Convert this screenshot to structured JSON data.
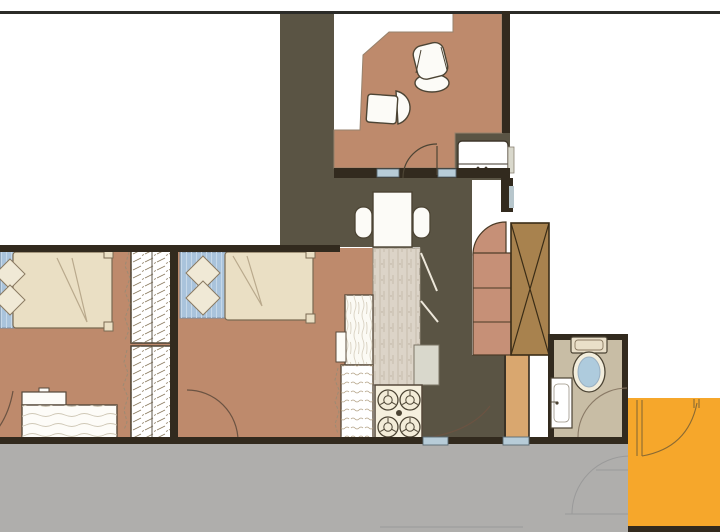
{
  "scene": {
    "type": "floor-plan"
  },
  "colors": {
    "floor_tan": "#BE8A6C",
    "hall_olive": "#5A5444",
    "corridor_gray": "#AFAEAC",
    "orange_room": "#F6A72B",
    "wall_dark": "#322A1E",
    "top_line": "#2B2B28",
    "blanket_cream": "#EADFC4",
    "bed_blue": "#A9C3DC",
    "pillow_cream": "#F0E9D6",
    "wardrobe_brown": "#A8824E",
    "shelf_salmon": "#C69077",
    "passage_tan": "#D9A76F",
    "bath_floor": "#C8BDA5",
    "toilet_blue": "#AECBDD",
    "threshold_blue": "#B7CCD8",
    "stove_cream": "#F6F0DE",
    "counter_marble": "#DCD4C8",
    "cabinet_wood_white": "#FBFAF4",
    "furniture_white": "#FCFBF7",
    "fridge_white": "#FFFFFF",
    "bath_fixture_cream": "#E9DFC9",
    "vent_blue": "#B7C6CC",
    "appliance_gray": "#D9D8CC",
    "sketch_faint": "#9A9A9A",
    "door_arc_brown": "#6B5342",
    "orange_door_line": "#8A6A33"
  }
}
